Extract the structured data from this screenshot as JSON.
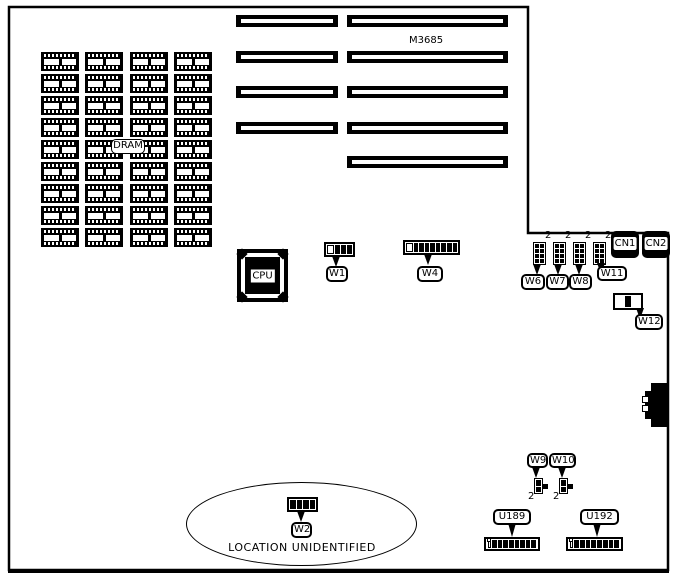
{
  "title": "M3685 motherboard layout diagram",
  "labels": {
    "m3685": "M3685",
    "dram": "DRAM",
    "cpu": "CPU",
    "w1": "W1",
    "w2": "W2",
    "w4": "W4",
    "w6": "W6",
    "w7": "W7",
    "w8": "W8",
    "w9": "W9",
    "w10": "W10",
    "w11": "W11",
    "w12": "W12",
    "cn1": "CN1",
    "cn2": "CN2",
    "u189": "U189",
    "u192": "U192",
    "pin2": "2",
    "note": "LOCATION UNIDENTIFIED"
  },
  "dram_grid": {
    "rows": 9,
    "cols": 4
  },
  "slots": {
    "left": 4,
    "right": 5
  },
  "chips": {
    "dip_segments": 8
  },
  "pin_blocks": {
    "w1": {
      "open": 1,
      "filled": 3
    },
    "w4": {
      "open": 1,
      "filled": 8
    },
    "w2": {
      "open": 0,
      "filled": 4
    },
    "w6": {
      "open": 0,
      "filled": 8
    },
    "w7": {
      "open": 0,
      "filled": 8
    },
    "w8": {
      "open": 0,
      "filled": 8
    },
    "w11j": {
      "open": 0,
      "filled": 8
    },
    "w9": {
      "open": 0,
      "filled": 2
    },
    "w10": {
      "open": 0,
      "filled": 2
    }
  },
  "colors": {
    "ink": "#000000",
    "paper": "#ffffff"
  }
}
